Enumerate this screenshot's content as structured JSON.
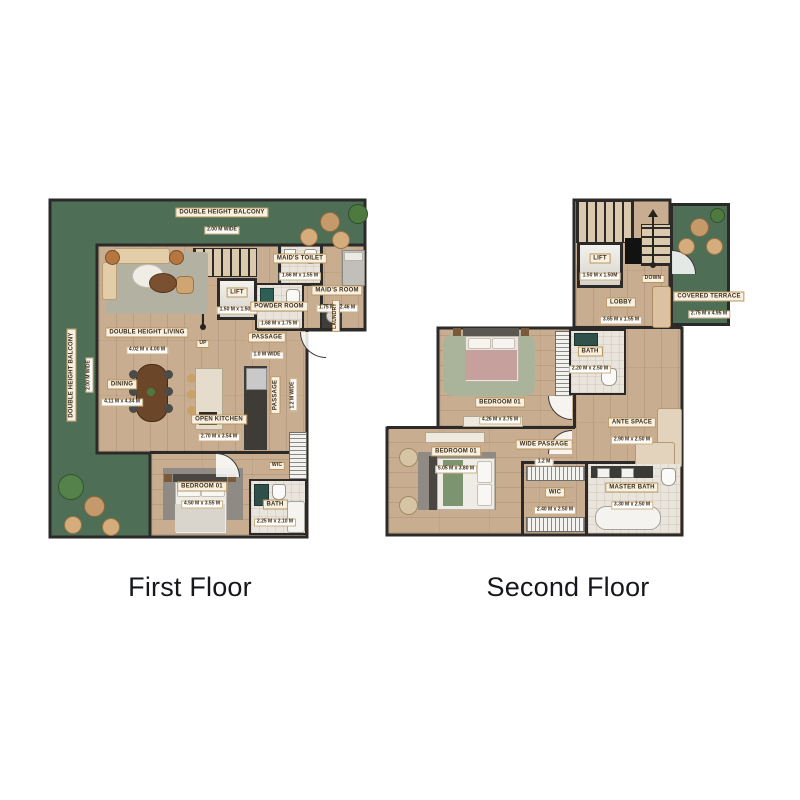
{
  "colors": {
    "wall": "#2b2a28",
    "balcony_green": "#4e6e56",
    "wood": "#c9ad90",
    "wood_dark": "#b89a7c",
    "tile": "#eae5dc",
    "label_bg": "#f8f1e2",
    "label_border": "#b8955e",
    "label_text": "#3b2a17",
    "title_color": "#15171a"
  },
  "floors": [
    {
      "id": "first-floor",
      "title": "First Floor",
      "labels": [
        {
          "id": "label-double-height-balcony-top",
          "name": "DOUBLE HEIGHT BALCONY",
          "dims": "2.00 M WIDE",
          "x": 174,
          "y": 20,
          "rot": 0
        },
        {
          "id": "label-double-height-balcony-left",
          "name": "DOUBLE HEIGHT BALCONY",
          "dims": "2.00 M WIDE",
          "x": 29,
          "y": 177,
          "rot": -90
        },
        {
          "id": "label-maids-toilet",
          "name": "MAID'S TOILET",
          "dims": "1.66 M x 1.55 M",
          "x": 252,
          "y": 66,
          "rot": 0
        },
        {
          "id": "label-maids-room",
          "name": "MAID'S ROOM",
          "dims": "1.75 M x 2.46 M",
          "x": 289,
          "y": 98,
          "rot": 0
        },
        {
          "id": "label-lift-1f",
          "name": "LIFT",
          "dims": "1.50 M x 1.50M",
          "x": 189,
          "y": 100,
          "rot": 0
        },
        {
          "id": "label-powder-room",
          "name": "POWDER ROOM",
          "dims": "1.68 M x 1.75 M",
          "x": 231,
          "y": 114,
          "rot": 0
        },
        {
          "id": "label-up",
          "name": "UP",
          "dims": null,
          "x": 155,
          "y": 142,
          "rot": 0,
          "small": true
        },
        {
          "id": "label-double-height-living",
          "name": "DOUBLE HEIGHT LIVING",
          "dims": "4.02 M x 4.00 M",
          "x": 99,
          "y": 140,
          "rot": 0
        },
        {
          "id": "label-passage-1f",
          "name": "PASSAGE",
          "dims": "1.0 M WIDE",
          "x": 219,
          "y": 145,
          "rot": 0
        },
        {
          "id": "label-dining",
          "name": "DINING",
          "dims": "4.11 M x 4.34 M",
          "x": 74,
          "y": 192,
          "rot": 0
        },
        {
          "id": "label-passage-vertical",
          "name": "PASSAGE",
          "dims": "1.2 M WIDE",
          "x": 233,
          "y": 197,
          "rot": -90
        },
        {
          "id": "label-open-kitchen",
          "name": "OPEN KITCHEN",
          "dims": "2.70 M x 3.54 M",
          "x": 171,
          "y": 227,
          "rot": 0
        },
        {
          "id": "label-wic-1f",
          "name": "WIC",
          "dims": null,
          "x": 229,
          "y": 264,
          "rot": 0,
          "small": true
        },
        {
          "id": "label-bedroom-01-1f",
          "name": "BEDROOM 01",
          "dims": "4.50 M x 3.55 M",
          "x": 154,
          "y": 294,
          "rot": 0
        },
        {
          "id": "label-bath-1f",
          "name": "BATH",
          "dims": "2.25 M x 2.10 M",
          "x": 227,
          "y": 312,
          "rot": 0
        },
        {
          "id": "label-laundry",
          "name": "LAUNDRY",
          "dims": null,
          "x": 284,
          "y": 118,
          "rot": -90,
          "small": true
        }
      ]
    },
    {
      "id": "second-floor",
      "title": "Second Floor",
      "labels": [
        {
          "id": "label-lift-2f",
          "name": "LIFT",
          "dims": "1.50 M x 1.50M",
          "x": 215,
          "y": 66,
          "rot": 0
        },
        {
          "id": "label-down",
          "name": "DOWN",
          "dims": null,
          "x": 268,
          "y": 77,
          "rot": 0,
          "small": true
        },
        {
          "id": "label-lobby",
          "name": "LOBBY",
          "dims": "3.65 M x 1.55 M",
          "x": 236,
          "y": 110,
          "rot": 0
        },
        {
          "id": "label-covered-terrace",
          "name": "COVERED TERRACE",
          "dims": "2.75 M x 4.95 M",
          "x": 324,
          "y": 104,
          "rot": 0
        },
        {
          "id": "label-bath-2f",
          "name": "BATH",
          "dims": "2.20 M x 2.50 M",
          "x": 205,
          "y": 159,
          "rot": 0
        },
        {
          "id": "label-bedroom-01-2f-top",
          "name": "BEDROOM 01",
          "dims": "4.26 M x 3.75 M",
          "x": 115,
          "y": 210,
          "rot": 0
        },
        {
          "id": "label-ante-space",
          "name": "ANTE SPACE",
          "dims": "2.90 M x 2.50 M",
          "x": 247,
          "y": 230,
          "rot": 0
        },
        {
          "id": "label-wide-passage",
          "name": "WIDE PASSAGE",
          "dims": "1.2 M",
          "x": 159,
          "y": 252,
          "rot": 0
        },
        {
          "id": "label-bedroom-01-2f-lower",
          "name": "BEDROOM 01",
          "dims": "5.05 M x 3.80 M",
          "x": 71,
          "y": 259,
          "rot": 0
        },
        {
          "id": "label-wic-2f",
          "name": "WIC",
          "dims": "2.40 M x 2.50 M",
          "x": 170,
          "y": 300,
          "rot": 0
        },
        {
          "id": "label-master-bath",
          "name": "MASTER BATH",
          "dims": "3.30 M x 2.50 M",
          "x": 247,
          "y": 295,
          "rot": 0
        }
      ]
    }
  ]
}
